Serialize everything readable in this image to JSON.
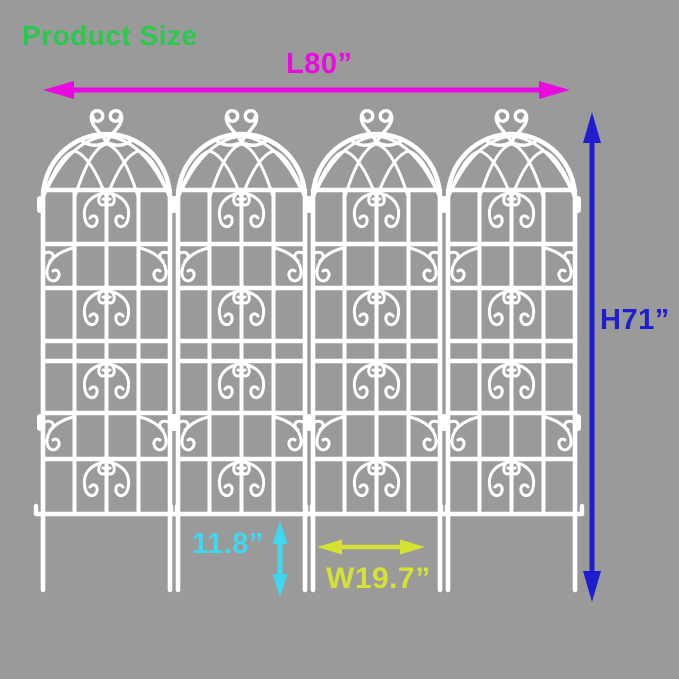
{
  "title": {
    "text": "Product Size",
    "color": "#2BC84E"
  },
  "dimensions": {
    "length": {
      "label": "L80”",
      "color": "#E90ADF",
      "orientation": "horizontal"
    },
    "height": {
      "label": "H71”",
      "color": "#1E1ECF",
      "orientation": "vertical"
    },
    "leg_height": {
      "label": "11.8”",
      "color": "#40D8F0",
      "orientation": "vertical"
    },
    "panel_width": {
      "label": "W19.7”",
      "color": "#D6E233",
      "orientation": "horizontal"
    }
  },
  "illustration": {
    "panel_count": 4,
    "panel_color": "#FFFFFF",
    "background_color": "#9A9A9A"
  }
}
